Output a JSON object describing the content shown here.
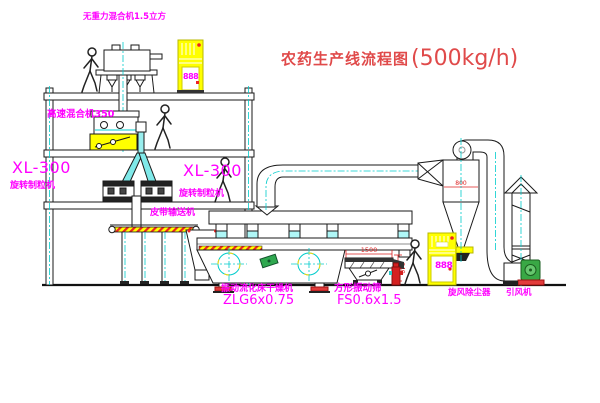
{
  "title": {
    "zh": "农药生产线流程图",
    "capacity": "(500kg/h)"
  },
  "labels": {
    "gravity_mixer": "无重力混合机1.5立方",
    "high_speed_mixer": "高速混合机350",
    "xl300_left": "XL-300",
    "granulator_left": "旋转制粒机",
    "xl300_right": "XL-300",
    "granulator_right": "旋转制粒机",
    "belt_conveyor": "皮带输送机",
    "dryer_name": "振动流化床干燥机",
    "dryer_model": "ZLG6x0.75",
    "sieve_name": "方形振动筛",
    "sieve_model": "FS0.6x1.5",
    "cyclone": "旋风除尘器",
    "fan": "引风机"
  },
  "dimensions": {
    "sieve_width": "1500",
    "sieve_height": "340",
    "cyclone_dia": "800"
  },
  "cabinets": {
    "display_1": "888",
    "display_2": "888"
  },
  "colors": {
    "label": "#FF00FF",
    "title": "#E04A4A",
    "highlight": "#FFFF00",
    "centerline": "#00CCCC",
    "accent": "#EE2222"
  }
}
